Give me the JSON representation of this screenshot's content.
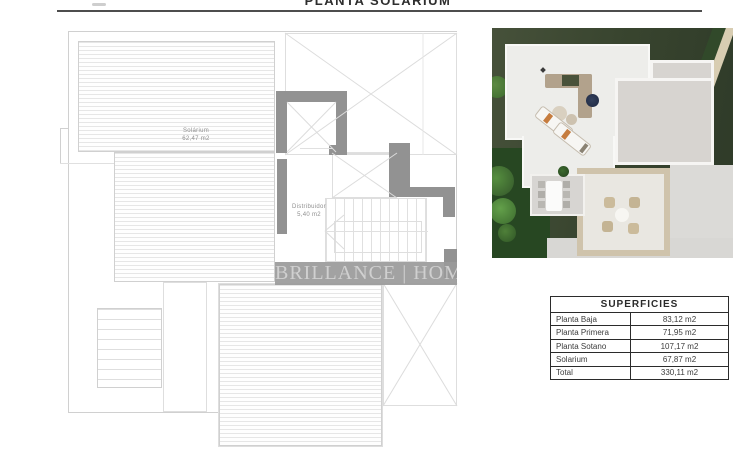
{
  "page": {
    "title": "PLANTA SOLARIUM"
  },
  "plan": {
    "rooms": [
      {
        "name": "Solárium",
        "area": "62,47 m2"
      },
      {
        "name": "Distribuidor",
        "area": "5,40 m2"
      }
    ],
    "watermark": "BRILLANCE | HOMES"
  },
  "table": {
    "header": "SUPERFICIES",
    "rows": [
      {
        "label": "Planta Baja",
        "value": "83,12 m2"
      },
      {
        "label": "Planta Primera",
        "value": "71,95 m2"
      },
      {
        "label": "Planta Sotano",
        "value": "107,17 m2"
      },
      {
        "label": "Solarium",
        "value": "67,87 m2"
      },
      {
        "label": "Total",
        "value": "330,11 m2"
      }
    ]
  }
}
